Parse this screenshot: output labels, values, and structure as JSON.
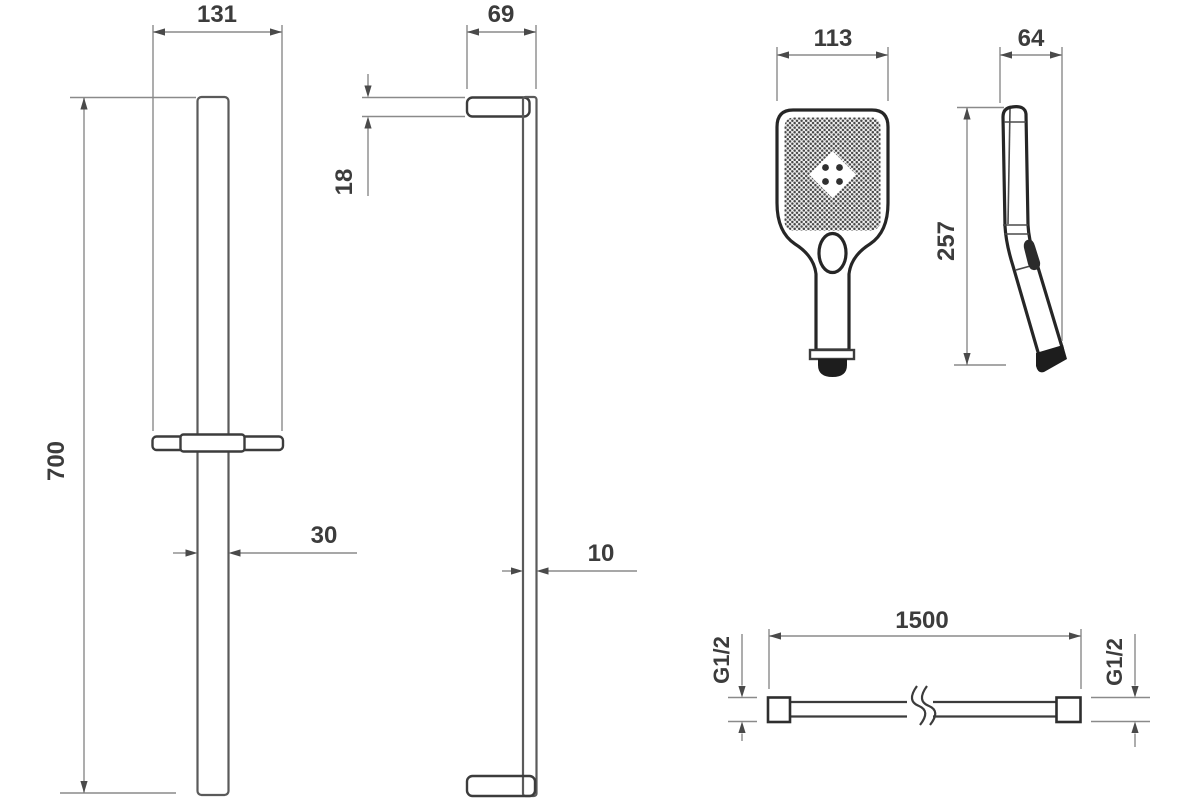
{
  "drawing": {
    "title": "shower-set-dimensional-drawing",
    "colors": {
      "background": "#ffffff",
      "object_outline": "#262626",
      "rail_line": "#5a5a5a",
      "dimension_line": "#8a8a8a",
      "label_text": "#3c3c3c"
    },
    "views": {
      "rail_front": {
        "bracket_width_mm": "131",
        "height_mm": "700",
        "bar_width_mm": "30"
      },
      "rail_side": {
        "depth_mm": "69",
        "bracket_thickness_mm": "18",
        "bar_depth_mm": "10"
      },
      "handset_front": {
        "width_mm": "113"
      },
      "handset_side": {
        "height_mm": "257",
        "depth_mm": "64"
      },
      "hose": {
        "length_mm": "1500",
        "left_thread": "G1/2",
        "right_thread": "G1/2"
      }
    }
  }
}
